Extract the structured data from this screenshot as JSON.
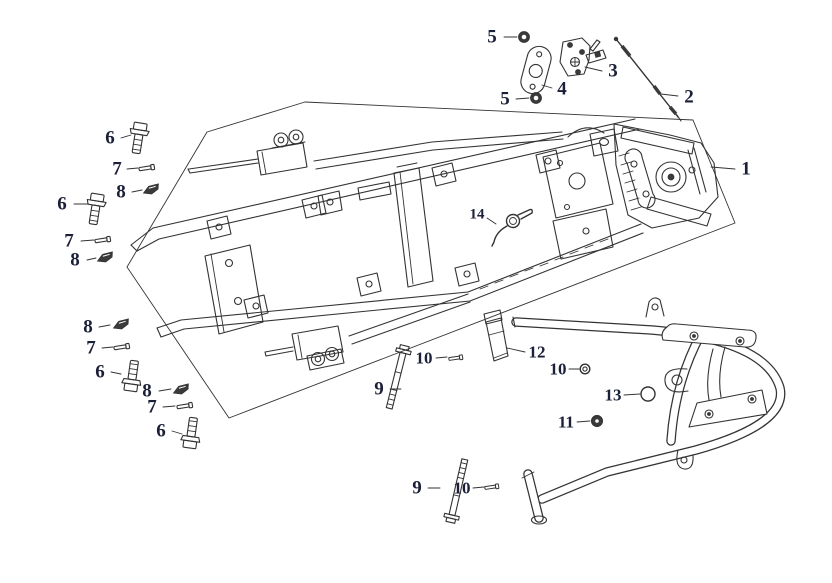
{
  "diagram": {
    "type": "exploded-parts-diagram",
    "background_color": "#ffffff",
    "line_color": "#333333",
    "label_color": "#1b2038",
    "callouts": [
      {
        "number": "5"
      },
      {
        "number": "3"
      },
      {
        "number": "4"
      },
      {
        "number": "5"
      },
      {
        "number": "2"
      },
      {
        "number": "1"
      },
      {
        "number": "6"
      },
      {
        "number": "7"
      },
      {
        "number": "8"
      },
      {
        "number": "6"
      },
      {
        "number": "7"
      },
      {
        "number": "8"
      },
      {
        "number": "14"
      },
      {
        "number": "8"
      },
      {
        "number": "7"
      },
      {
        "number": "6"
      },
      {
        "number": "8"
      },
      {
        "number": "7"
      },
      {
        "number": "6"
      },
      {
        "number": "10"
      },
      {
        "number": "12"
      },
      {
        "number": "10"
      },
      {
        "number": "9"
      },
      {
        "number": "13"
      },
      {
        "number": "11"
      },
      {
        "number": "9"
      },
      {
        "number": "10"
      }
    ]
  }
}
